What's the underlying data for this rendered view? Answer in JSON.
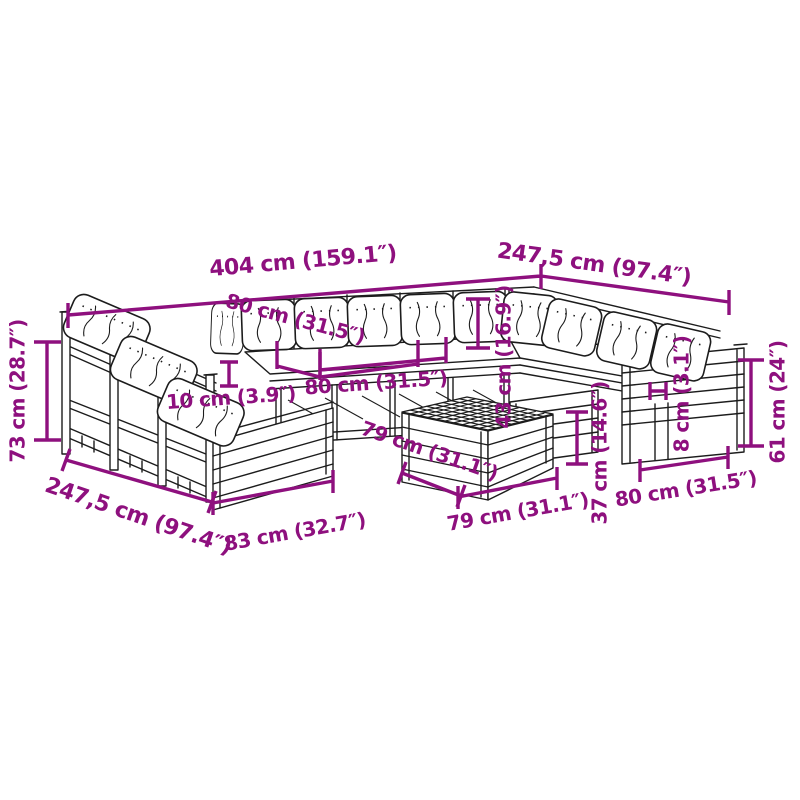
{
  "diagram": {
    "type": "product-dimension-diagram",
    "subject": "modular-garden-sofa-set-with-table",
    "accent_color": "#8E107E",
    "line_color": "#1c1c1c",
    "background_color": "#ffffff",
    "dimensions": [
      {
        "id": "total-width-back",
        "label": "404 cm (159.1″)"
      },
      {
        "id": "total-depth-right",
        "label": "247,5 cm (97.4″)"
      },
      {
        "id": "back-cushion-width",
        "label": "80 cm (31.5″)"
      },
      {
        "id": "seat-module-width",
        "label": "80 cm (31.5″)"
      },
      {
        "id": "armrest-gap",
        "label": "10 cm (3.9″)"
      },
      {
        "id": "backrest-height",
        "label": "73 cm (28.7″)"
      },
      {
        "id": "total-depth-left",
        "label": "247,5 cm (97.4″)"
      },
      {
        "id": "front-module-width",
        "label": "83 cm (32.7″)"
      },
      {
        "id": "table-depth",
        "label": "79 cm (31.1″)"
      },
      {
        "id": "table-width",
        "label": "79 cm (31.1″)"
      },
      {
        "id": "seat-cushion-height",
        "label": "43 cm (16.9″)"
      },
      {
        "id": "table-height",
        "label": "37 cm (14.6″)"
      },
      {
        "id": "slat-gap",
        "label": "8 cm (3.1″)"
      },
      {
        "id": "right-module-width",
        "label": "80 cm (31.5″)"
      },
      {
        "id": "side-panel-height",
        "label": "61 cm (24″)"
      }
    ]
  }
}
